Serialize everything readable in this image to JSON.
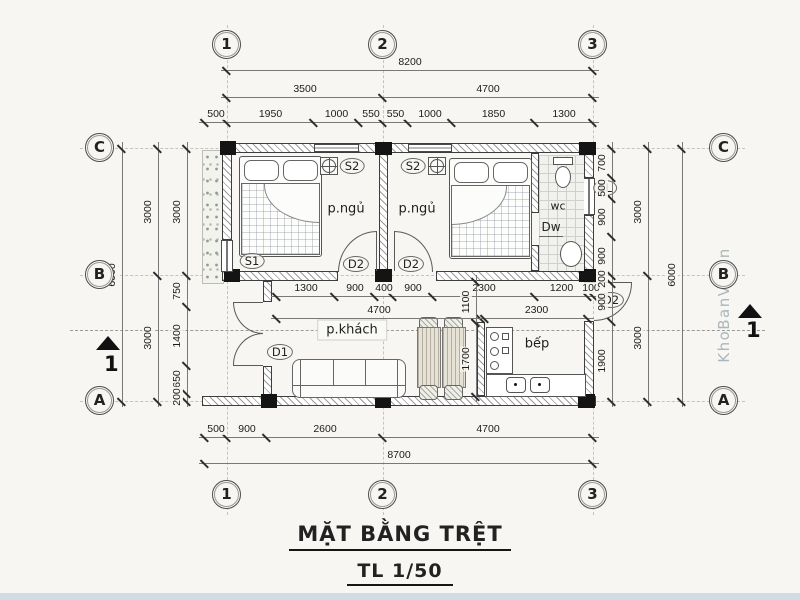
{
  "title": {
    "name": "MẶT BẰNG TRỆT",
    "scale": "TL 1/50"
  },
  "watermark": "KhoBanVe.vn",
  "grid": {
    "cols": [
      "1",
      "2",
      "3"
    ],
    "rows": [
      "C",
      "B",
      "A"
    ]
  },
  "rooms": {
    "bedroom1": "p.ngủ",
    "bedroom2": "p.ngủ",
    "living": "p.khách",
    "kitchen": "bếp",
    "wc": "wc"
  },
  "marks": {
    "s1": "S1",
    "s2_left": "S2",
    "s2_right": "S2",
    "d1": "D1",
    "d2_left": "D2",
    "d2_right": "D2",
    "d2_kitchen": "D2",
    "dw": "Dw",
    "sl": "SL"
  },
  "section": {
    "label": "1"
  },
  "dims": {
    "top_total": "8200",
    "top_bays": [
      "3500",
      "4700"
    ],
    "top_detail": [
      "500",
      "1950",
      "1000",
      "550",
      "550",
      "1000",
      "1850",
      "1300"
    ],
    "bottom_detail": [
      "500",
      "900",
      "2600",
      "4700"
    ],
    "bottom_total": "8700",
    "left_outer": "6000",
    "left_bays": [
      "3000",
      "3000"
    ],
    "left_detail": [
      "3000",
      "750",
      "1400",
      "650",
      "200"
    ],
    "right_detail": [
      "700",
      "500",
      "900",
      "900",
      "200",
      "900",
      "1900"
    ],
    "right_bays": [
      "3000",
      "3000"
    ],
    "right_outer": "6000",
    "interior_b": [
      "1300",
      "900",
      "400",
      "900",
      "2300",
      "1200",
      "100"
    ],
    "living_width": "4700",
    "kitchen_width": "2300",
    "corridor_depth": "1100",
    "dining_depth": "1700"
  },
  "colors": {
    "paper": "#f7f6f2",
    "line": "#3d3d3d",
    "column": "#141414",
    "watermark": "#aab7bd",
    "footer_strip": "#cfdce6"
  }
}
